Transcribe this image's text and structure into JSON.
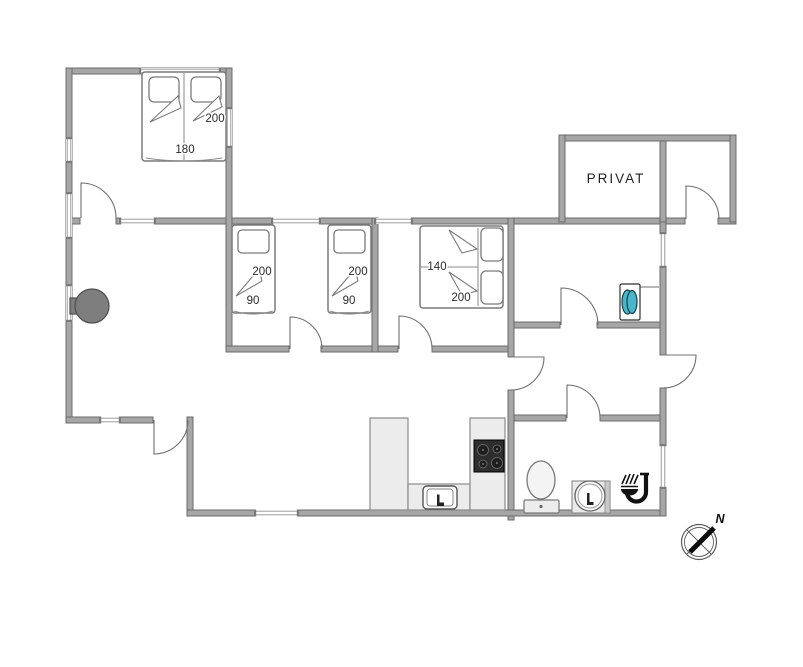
{
  "floorplan": {
    "labels": {
      "bed_master": {
        "length": "200",
        "width": "180"
      },
      "bed_single_a": {
        "length": "200",
        "width": "90"
      },
      "bed_single_b": {
        "length": "200",
        "width": "90"
      },
      "bed_double_small": {
        "width": "140",
        "length": "200"
      },
      "room_private": "PRIVAT",
      "compass_north": "N"
    },
    "colors": {
      "wall": "#a6a6a6",
      "wall_edge": "#6b6b6b",
      "door_line": "#707070",
      "furniture_line": "#7a7a7a",
      "light_fill": "#ececec",
      "cooktop": "#2d2d2d",
      "washer_drum": "#49b6c9",
      "stove": "#7e7e7e",
      "icon": "#111111",
      "label_text": "#2a2a2a"
    }
  }
}
